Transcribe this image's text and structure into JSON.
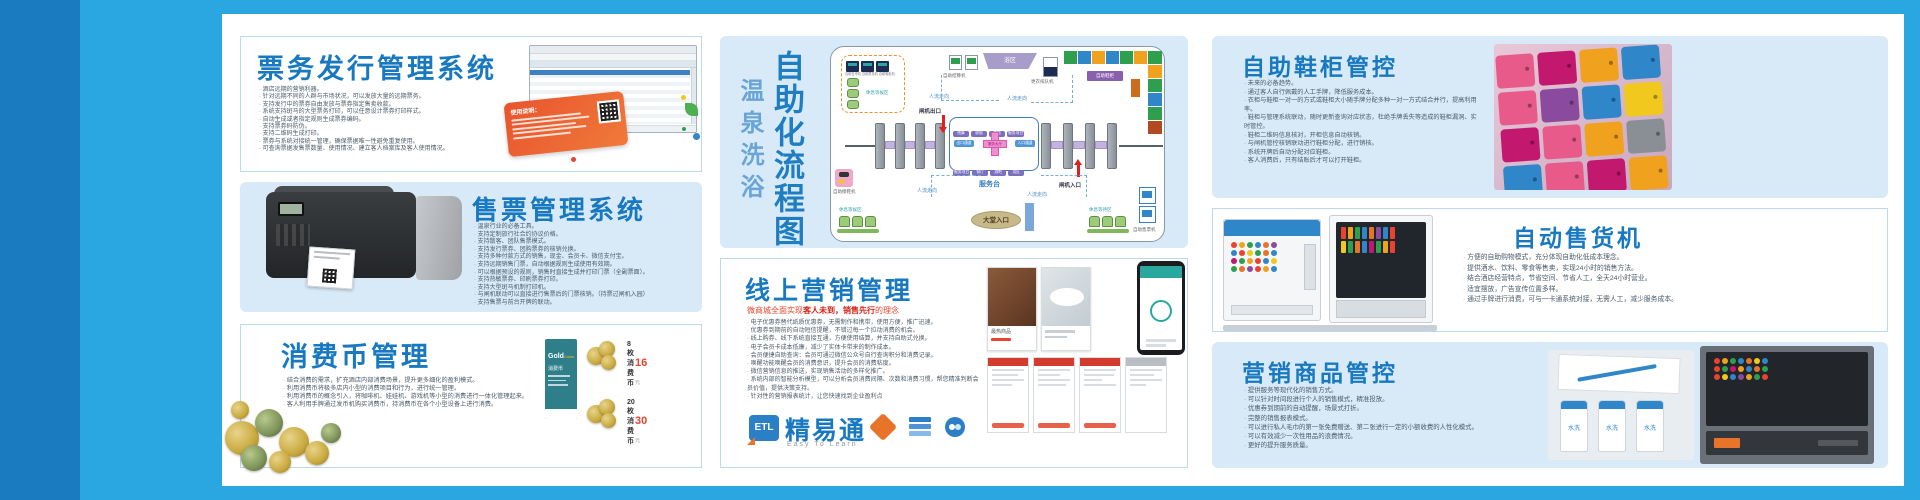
{
  "colors": {
    "frame_blue": "#2AA7E0",
    "stripe_blue": "#1A7BC0",
    "panel_blue": "#D8EAF8",
    "title_blue": "#1879C0",
    "accent_red": "#E8432E",
    "coupon_orange": "#E8542E",
    "card_teal": "#2E7F8A"
  },
  "panels": {
    "ticket_issue": {
      "title": "票务发行管理系统",
      "coupon_title": "使用说明：",
      "bullets": [
        "酒店远期的营销利器。",
        "针对远期不同的人群与市场状况，可以发放大量的远期票务。",
        "支持发行中的票券自由发放与票券指定售卖收款。",
        "系统支持斑马的大型票务打印，可以任意设计票券打印样式。",
        "自动生成或者指定规则生成票券编码。",
        "支持票券码防伪。",
        "支持二维码生成打印。",
        "票券与系统对接统一管理，确保票据唯一性避免重复使用。",
        "可查询票据发售票数量、使用情况、建立客人档案库及客人使用情况。"
      ]
    },
    "ticket_sale": {
      "title": "售票管理系统",
      "bullets": [
        "温泉行业的必备工具。",
        "支持定制旅行社合约协议价格。",
        "支持散客、团队售票模式。",
        "支持发行票券、团购票券的核销兑换。",
        "支持多种付款方式的销售，现金、会员卡、微信支付宝。",
        "支持远期销售门票，自动根据规则生成使用有效期。",
        "可以根据预设的规则，销售时直接生成并打印门票（全副票面）。",
        "支持热敏票券、印刷票券打印。",
        "支持大型斑马机制打印机。",
        "与闸机联动可以直接进行售票后的门票核销。（持票过闸机入园）",
        "支持售票与前台开牌的联动。"
      ]
    },
    "coin": {
      "title": "消费币管理",
      "bullets": [
        "结合消费的需求，扩充酒店内部消费场景，提升更多细化的盈利模式。",
        "利用消费币将极多店内小型的消费项目和行为，进行统一管理。",
        "利用消费币的概念引入，将咖啡机、娃娃机、游戏机等小型的消费进行一体化管理起来。",
        "客人利用手牌通过发币机购买消费币，持消费币在各个小型设备上进行消费。"
      ],
      "card": {
        "brand": "Gold",
        "brand_sub": "Coins",
        "name": "消费币"
      },
      "prices": [
        {
          "label": "8枚消费币",
          "amount": "16",
          "unit": "元"
        },
        {
          "label": "20枚消费币",
          "amount": "30",
          "unit": "元"
        }
      ]
    },
    "flow": {
      "title_main": "自助化流程图",
      "title_sub": "温泉洗浴"
    },
    "online": {
      "title": "线上营销管理",
      "subtitle_prefix": "微商城全面实现",
      "subtitle_em": "客人未到，销售先行",
      "subtitle_suffix": "的理念",
      "bullets": [
        "电子优惠券替代纸质优惠券，无需制作和携带，使用方便，推广迅速。",
        "优惠券到期前的自动短信提醒，不错过每一个拉动消费的机会。",
        "线上购券、线下系统直接互通，方便使用结算，并支持自助式兑换。",
        "电子会员卡成本低廉，减少了实体卡带来的制作成本。",
        "会员便捷自助查询：会员可通过微信公众号自行查询积分和消费记录。",
        "唤醒功能唤醒会员的消费意识，提升会员的消费粘度。",
        "微信营销信息的推送，实现销售活动的多样化推广。",
        "系统内部的智能分析模型，可以分析会员消费间隔、次数和消费习惯，帮您精准判断会员价值，提供决策支持。",
        "针对性的营销报表统计，让您快速找到企业盈利点"
      ],
      "logo": {
        "mark": "ETL",
        "name": "精易通",
        "tagline": "Easy To Learn"
      },
      "phone_caption": "最热商品"
    },
    "shoe": {
      "title": "自助鞋柜管控",
      "bullets": [
        "未来的必备趋势。",
        "通过客人自行佩戴的人工手牌，降低服务成本。",
        "衣柜与鞋柜一对一的方式或鞋柜大小随手牌分配多种一对一方式结合并行，提高利用率。",
        "鞋柜与管理系统联动，随时更新查询对应状态，杜绝手牌丢失等造成的鞋柜漏洞、实时管控。",
        "鞋柜二维码信息核对，开柜信息自动核销。",
        "与闸机管控核销联动进行鞋柜分配，进行销核。",
        "系统开牌后自动分配对应鞋柜。",
        "客人消费后，只有结账后才可以打开鞋柜。"
      ]
    },
    "vending": {
      "title": "自动售货机",
      "bullets": [
        "方便的自助购物模式，充分体现自助化低成本理念。",
        "提供酒水、饮料、零食等售卖，实现24小时的销售方法。",
        "结合酒店经营特点，节省空间、节省人工，全天24小时营业。",
        "适宜摆放，广告宣传位置多样。",
        "通过手牌进行消费，可与一卡通系统对接，无需人工，减少服务成本。"
      ]
    },
    "goods": {
      "title": "营销商品管控",
      "bullets": [
        "提供服务等现代化的销售方式。",
        "可以针对时间段进行个人的销售模式，精准投放。",
        "优惠券到期前的自动提醒，场景式打折。",
        "完整的销售报表模式。",
        "可以进行私人毛巾的第一张免费赠送、第二张进行一定的小额收费的人性化模式。",
        "可以有效减少一次性用品的浪费情况。",
        "更好的提升服务质量。"
      ],
      "bottle_label": "水洗"
    }
  },
  "diagram": {
    "machines_box": [
      "自助售币机",
      "自助票务机",
      "自助鞋柜机"
    ],
    "rest_area": "休息等候区",
    "settle": "自助结算机",
    "bath": "浴区",
    "queue": "更衣排队机",
    "lockers": "自助鞋柜",
    "gate_exit": "闸机出口",
    "gate_entry": "闸机入口",
    "service_desk": "服务台",
    "lobby": "大堂入口",
    "shine": "自助擦鞋机",
    "wait_area": "休息等待区",
    "tvm": "自助售票机",
    "flow_label": "人流走向",
    "hall_center": "服务大厅",
    "chips_top": [
      "结算",
      "收银",
      "商超",
      "服务项目"
    ],
    "chips_bottom": [
      "服务项目",
      "餐厅",
      "酒吧",
      "浴区"
    ],
    "chip_in": "入口通道",
    "chip_out": "出口通道"
  },
  "palettes": {
    "strip_h": [
      "#2E9E4F",
      "#2F86C8",
      "#F0A11E",
      "#2F86C8",
      "#2E9E4F",
      "#F0A11E"
    ],
    "strip_v": [
      "#2E9E4F",
      "#F0A11E",
      "#2E9E4F",
      "#2F86C8",
      "#2E9E4F",
      "#B14A20"
    ],
    "locker_photo": [
      "#E85A8A",
      "#C2186E",
      "#F0A11E",
      "#2F86C8",
      "#E85A8A",
      "#8A4A9E",
      "#2F86C8",
      "#F0C81E",
      "#C2186E",
      "#E85A8A",
      "#F0A11E",
      "#8A8F96",
      "#2F86C8",
      "#E85A8A",
      "#C2186E",
      "#F0A11E"
    ],
    "products1": [
      "#E8432E",
      "#F0A11E",
      "#2E9E4F",
      "#2F86C8",
      "#E8742A",
      "#8A4A9E",
      "#2F86C8",
      "#E8432E",
      "#F0C81E",
      "#2E9E4F",
      "#E8742A",
      "#2F86C8",
      "#C2186E",
      "#2E9E4F",
      "#F0A11E",
      "#E8432E",
      "#2F86C8",
      "#F0C81E",
      "#2E9E4F",
      "#E8742A",
      "#8A4A9E",
      "#E8432E",
      "#F0A11E",
      "#2F86C8"
    ],
    "bottles": [
      "#E8432E",
      "#F0A11E",
      "#2E9E4F",
      "#2F86C8",
      "#E8742A",
      "#8A4A9E",
      "#2F86C8",
      "#E8432E",
      "#F0C81E",
      "#2E9E4F",
      "#E8742A",
      "#2F86C8",
      "#C2186E",
      "#2E9E4F",
      "#F0A11E",
      "#E8432E"
    ],
    "shelf": [
      "#E8432E",
      "#F0A11E",
      "#2E9E4F",
      "#2F86C8",
      "#E8742A",
      "#F0C81E",
      "#2F86C8",
      "#E8432E",
      "#2E9E4F",
      "#C2186E",
      "#F0A11E",
      "#2F86C8",
      "#E8742A",
      "#2E9E4F",
      "#E8432E",
      "#F0C81E",
      "#2F86C8",
      "#8A4A9E",
      "#F0A11E",
      "#2E9E4F",
      "#E8432E"
    ]
  }
}
